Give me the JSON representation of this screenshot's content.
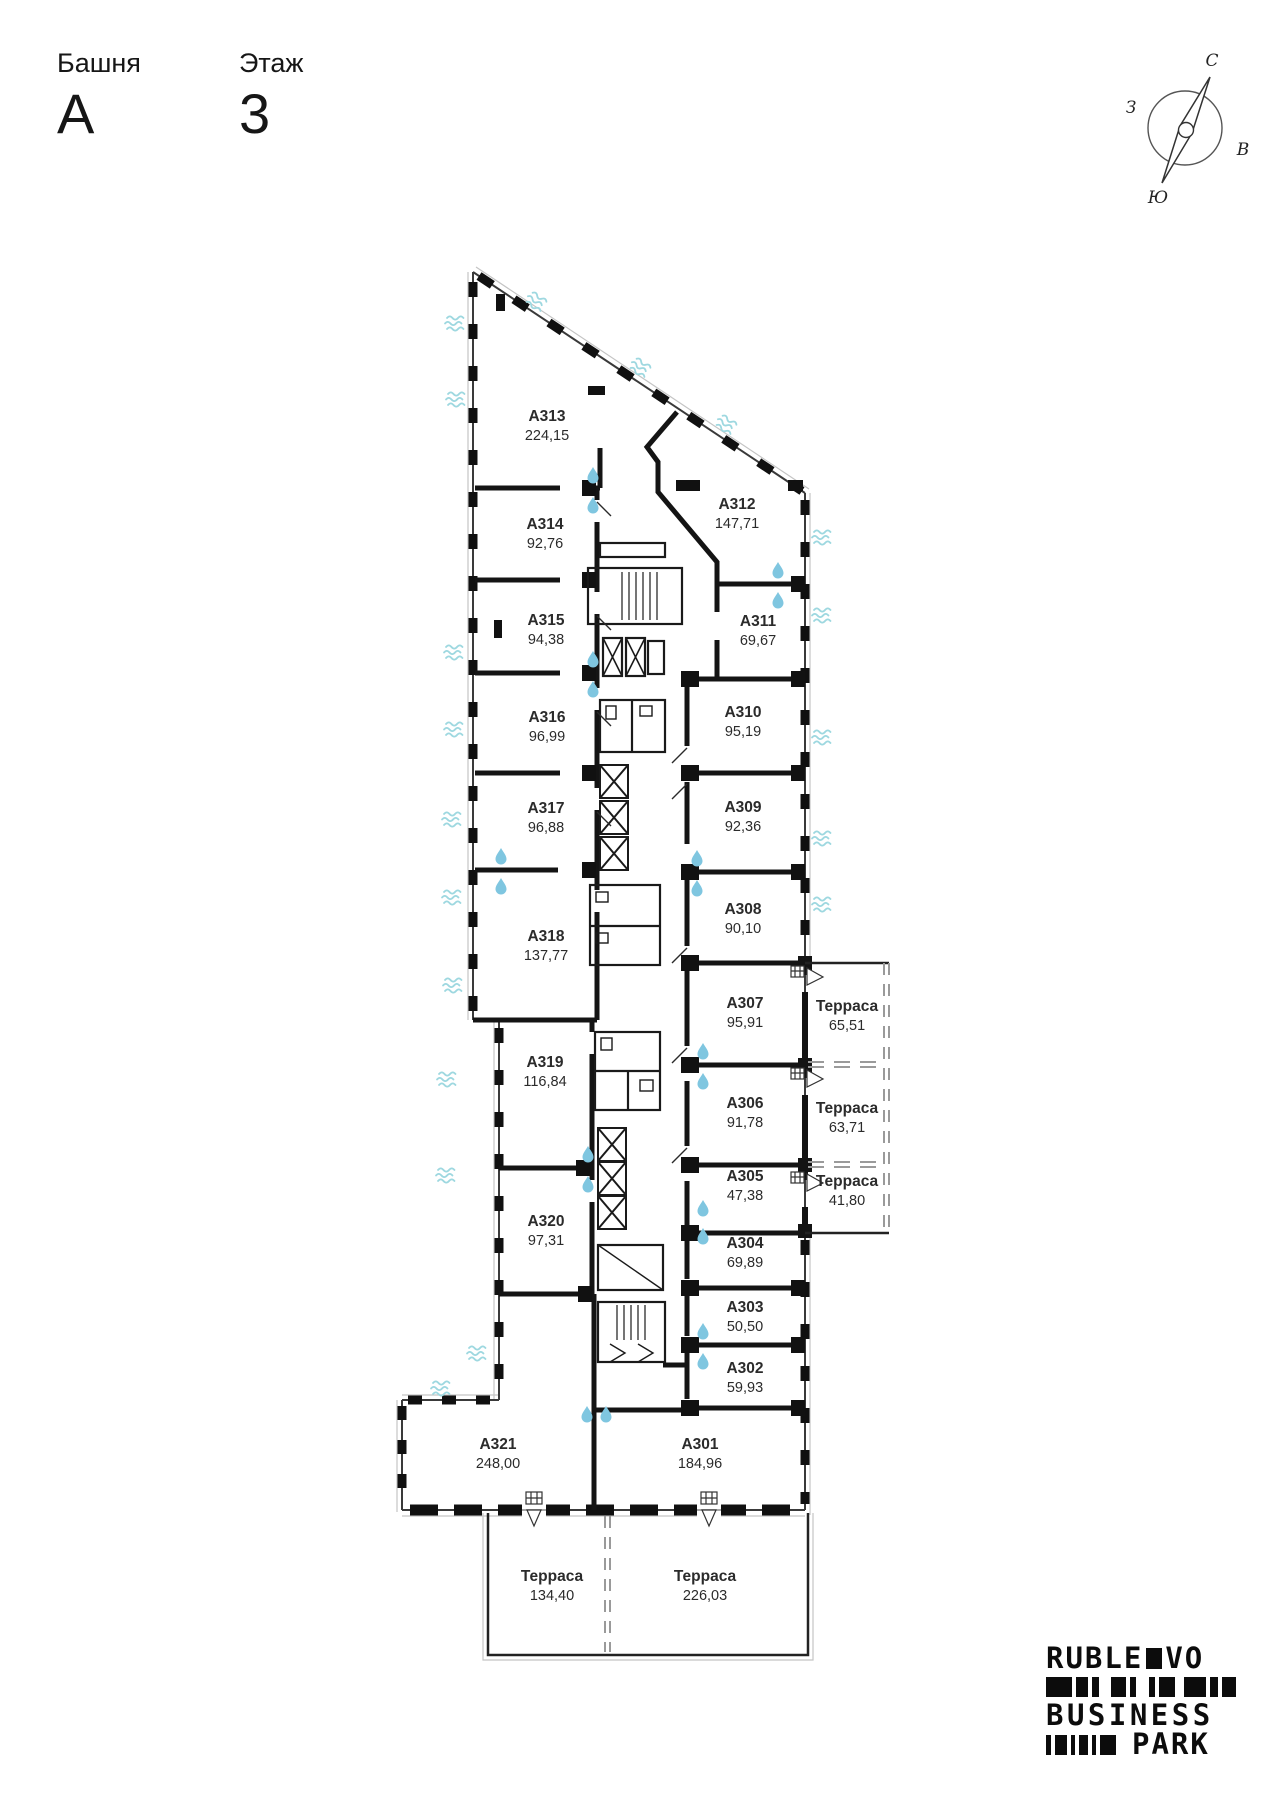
{
  "header": {
    "tower_label": "Башня",
    "tower_value": "А",
    "floor_label": "Этаж",
    "floor_value": "3"
  },
  "compass": {
    "north": "С",
    "south": "Ю",
    "east": "В",
    "west": "З"
  },
  "plan": {
    "rooms": [
      {
        "id": "А313",
        "area": "224,15"
      },
      {
        "id": "А314",
        "area": "92,76"
      },
      {
        "id": "А315",
        "area": "94,38"
      },
      {
        "id": "А316",
        "area": "96,99"
      },
      {
        "id": "А317",
        "area": "96,88"
      },
      {
        "id": "А318",
        "area": "137,77"
      },
      {
        "id": "А319",
        "area": "116,84"
      },
      {
        "id": "А320",
        "area": "97,31"
      },
      {
        "id": "А321",
        "area": "248,00"
      },
      {
        "id": "А301",
        "area": "184,96"
      },
      {
        "id": "А302",
        "area": "59,93"
      },
      {
        "id": "А303",
        "area": "50,50"
      },
      {
        "id": "А304",
        "area": "69,89"
      },
      {
        "id": "А305",
        "area": "47,38"
      },
      {
        "id": "А306",
        "area": "91,78"
      },
      {
        "id": "А307",
        "area": "95,91"
      },
      {
        "id": "А308",
        "area": "90,10"
      },
      {
        "id": "А309",
        "area": "92,36"
      },
      {
        "id": "А310",
        "area": "95,19"
      },
      {
        "id": "А311",
        "area": "69,67"
      },
      {
        "id": "А312",
        "area": "147,71"
      }
    ],
    "terraces": [
      {
        "label": "Терраса",
        "area": "65,51"
      },
      {
        "label": "Терраса",
        "area": "63,71"
      },
      {
        "label": "Терраса",
        "area": "41,80"
      },
      {
        "label": "Терраса",
        "area": "134,40"
      },
      {
        "label": "Терраса",
        "area": "226,03"
      }
    ]
  },
  "logo": {
    "word1a": "RUBLE",
    "word1b": "VO",
    "word2": "BUSINESS",
    "word3": "PARK"
  },
  "colors": {
    "wall": "#141414",
    "water_drop": "#7fc6e0",
    "window_wave": "#9ed8e0",
    "terrace_dash": "#9a9a9a"
  }
}
